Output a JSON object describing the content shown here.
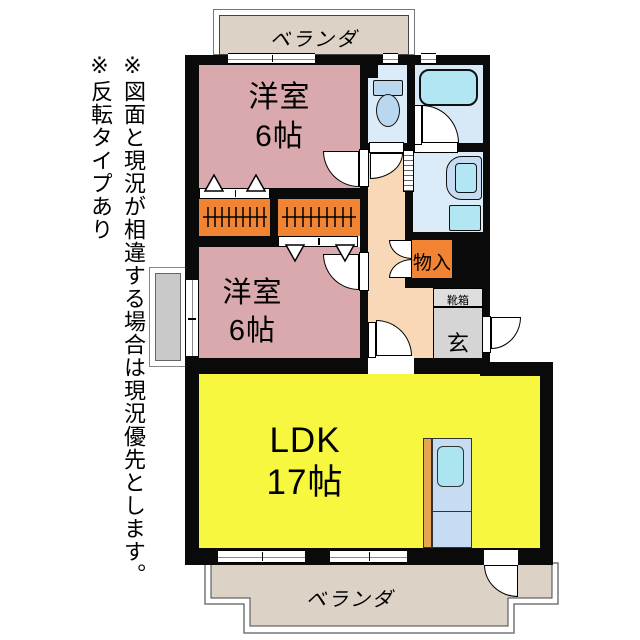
{
  "notes": {
    "disclaimer": "※図面と現況が相違する場合は現況優先とします。",
    "reverse_type": "※反転タイプあり"
  },
  "floor_plan": {
    "veranda_top": {
      "label": "ベランダ"
    },
    "veranda_bottom": {
      "label": "ベランダ"
    },
    "bedroom_top": {
      "label": "洋室",
      "size": "6帖"
    },
    "bedroom_bottom": {
      "label": "洋室",
      "size": "6帖"
    },
    "ldk": {
      "label": "LDK",
      "size": "17帖"
    },
    "storage": {
      "label": "物入"
    },
    "shoe_box": {
      "label": "靴箱"
    },
    "entrance": {
      "label": "玄"
    }
  },
  "colors": {
    "wall": "#0a0a0a",
    "bedroom-pink": "#d9a9ae",
    "closet-orange": "#f08433",
    "corridor-peach": "#f8d8b6",
    "ldk-yellow": "#f7f740",
    "wet-blue": "#dcebf8",
    "bath-blue": "#d7e9f7",
    "fixture-blue": "#b9d8f0",
    "fixture-cyan": "#b2e6f2",
    "veranda-beige": "#dcd3c6",
    "entrance-gray": "#d5d5d5",
    "shoebox-gray": "#dedede",
    "sidebox-gray": "#c9c9c9",
    "kitchen-panel": "#c6dcf2",
    "kitchen-orange": "#e8a455",
    "kitchen-sink": "#ace5ef"
  }
}
